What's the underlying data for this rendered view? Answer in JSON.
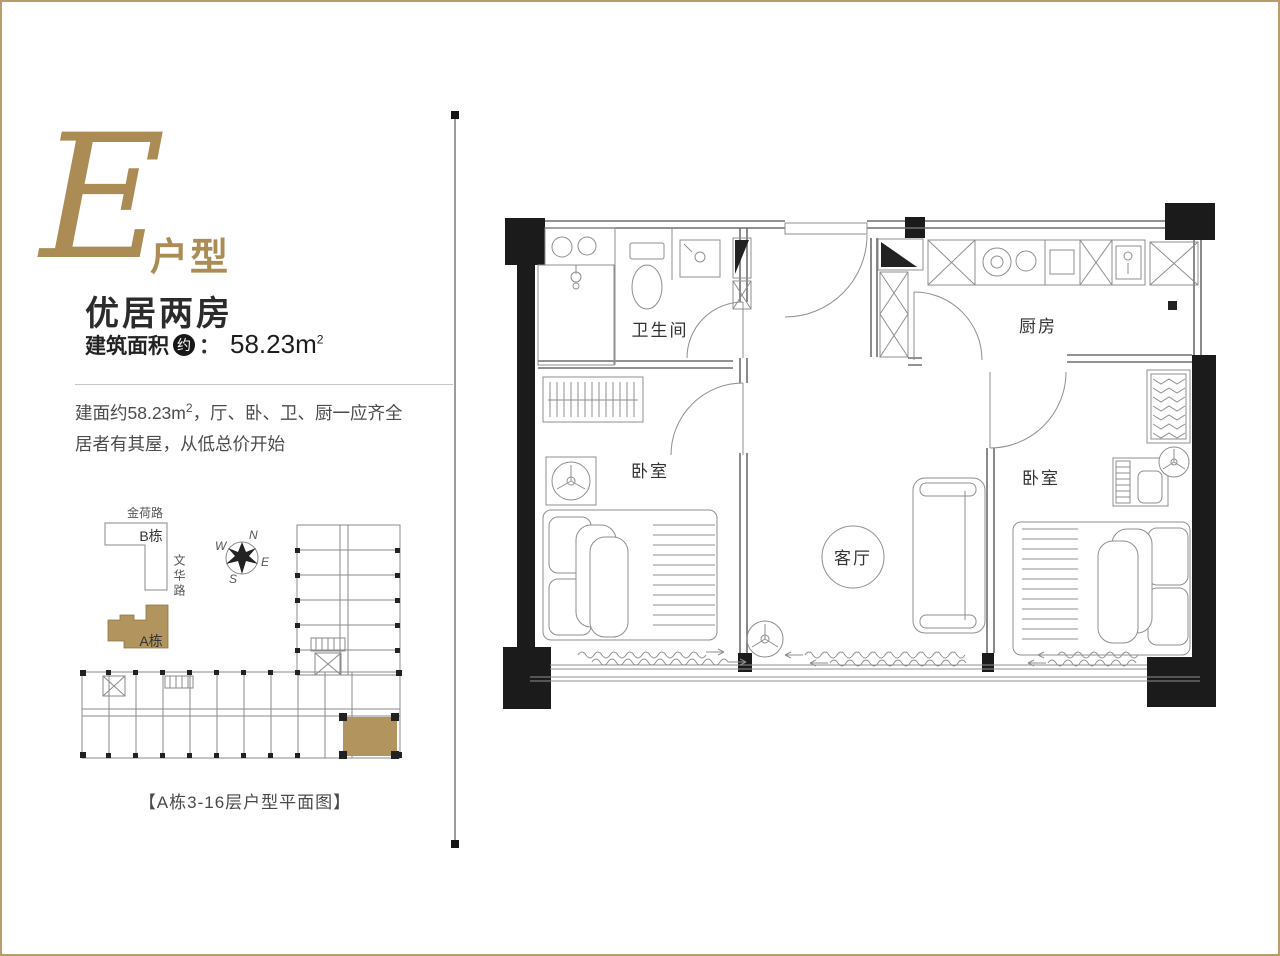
{
  "page": {
    "border_color": "#b79c6c",
    "accent_gold": "#ab8c55"
  },
  "unit": {
    "letter": "E",
    "letter_suffix": "户型",
    "title": "优居两房",
    "area": {
      "label": "建筑面积",
      "approx_badge": "约",
      "colon": "：",
      "value": "58.23m",
      "sup": "2"
    },
    "description": {
      "line1_pre": "建面约58.23m",
      "line1_sup": "2",
      "line1_post": "，厅、卧、卫、厨一应齐全",
      "line2": "居者有其屋，从低总价开始"
    }
  },
  "site_plan": {
    "road_top": "金荷路",
    "road_side": "文华路",
    "building_b": "B栋",
    "building_a": "A栋",
    "compass": {
      "n": "N",
      "e": "E",
      "s": "S",
      "w": "W"
    },
    "caption": "【A栋3-16层户型平面图】"
  },
  "floor_plan": {
    "bathroom": "卫生间",
    "kitchen": "厨房",
    "bedroom_left": "卧室",
    "bedroom_right": "卧室",
    "living_room": "客厅"
  }
}
